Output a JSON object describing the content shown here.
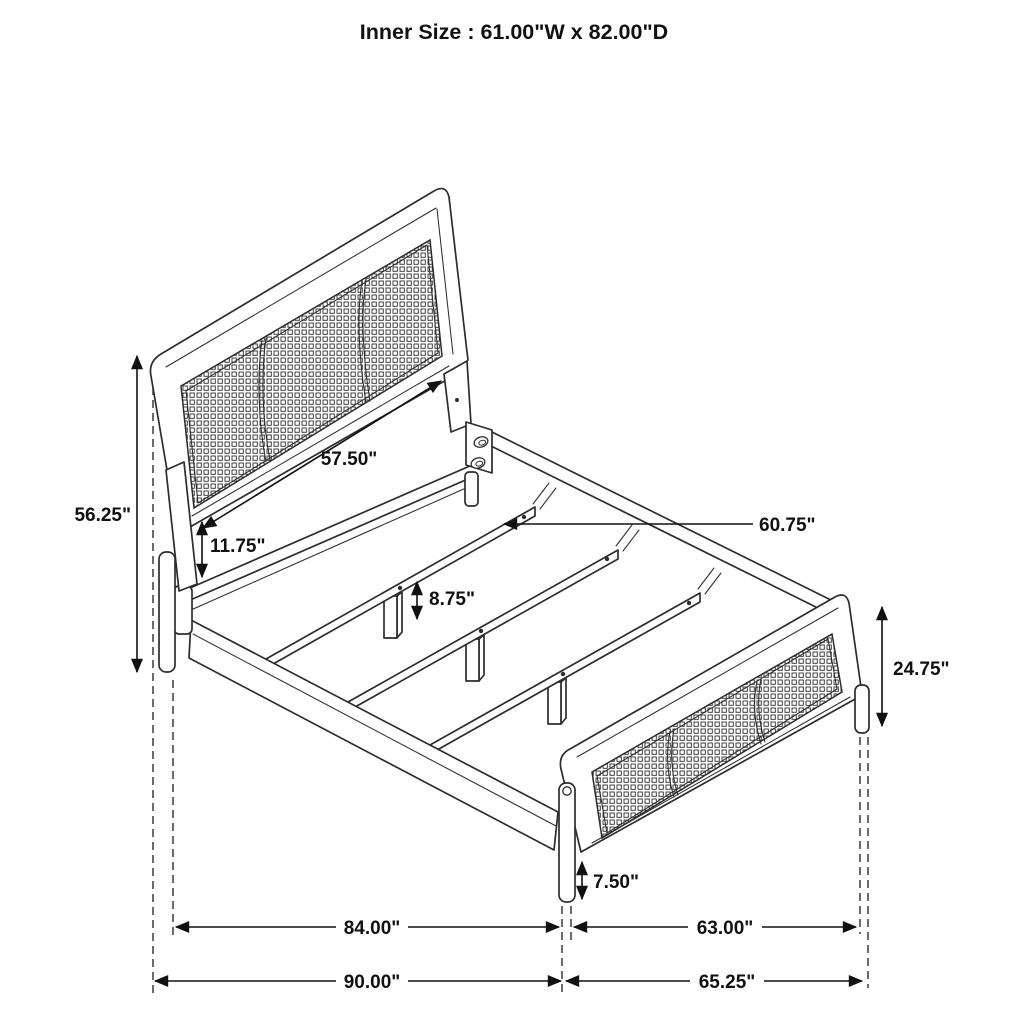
{
  "diagram": {
    "title": "Inner Size : 61.00\"W x 82.00\"D",
    "dims": {
      "headboard_height": "56.25\"",
      "headboard_width": "57.50\"",
      "under_headboard_clearance": "11.75\"",
      "slat_length": "60.75\"",
      "slat_support_height": "8.75\"",
      "footboard_height": "24.75\"",
      "footboard_leg_height": "7.50\"",
      "side_rail_length": "84.00\"",
      "footboard_span": "63.00\"",
      "overall_length": "90.00\"",
      "overall_width": "65.25\""
    }
  }
}
